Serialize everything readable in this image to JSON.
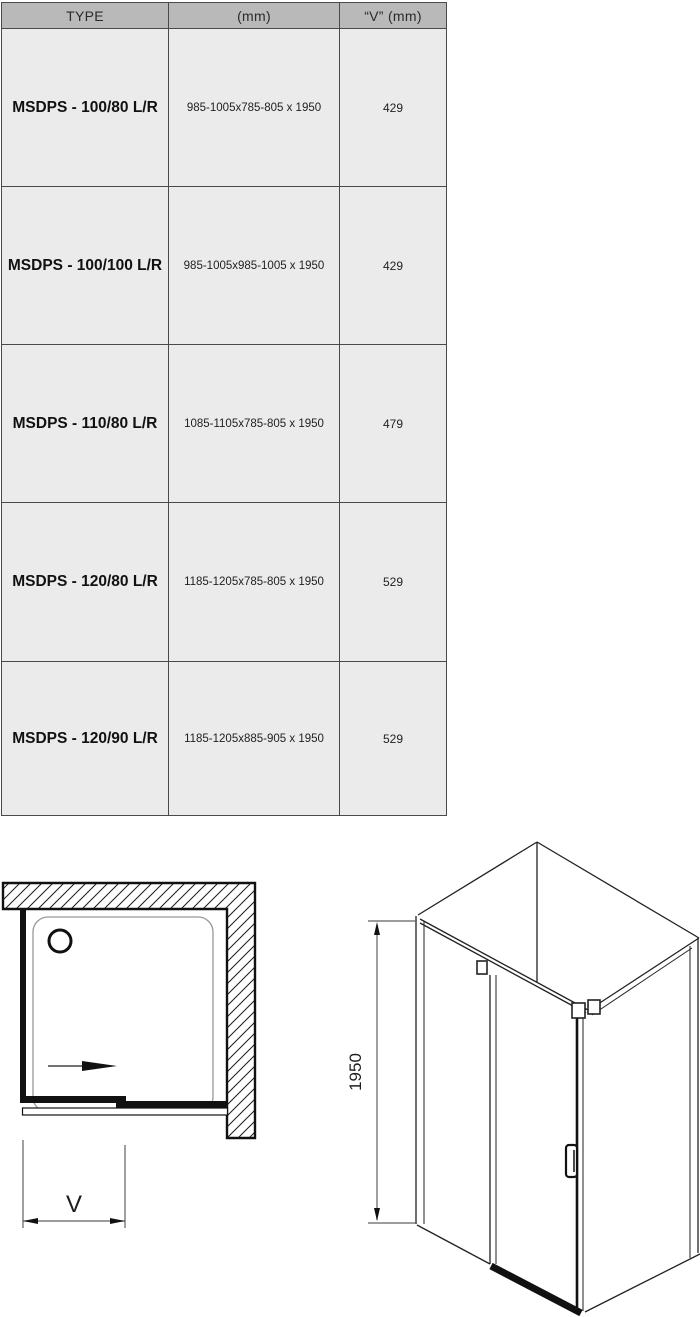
{
  "table": {
    "headers": [
      "TYPE",
      "(mm)",
      "“V”  (mm)"
    ],
    "rows": [
      {
        "type": "MSDPS - 100/80 L/R",
        "dimensions": "985-1005x785-805 x 1950",
        "v": "429"
      },
      {
        "type": "MSDPS - 100/100 L/R",
        "dimensions": "985-1005x985-1005 x 1950",
        "v": "429"
      },
      {
        "type": "MSDPS - 110/80 L/R",
        "dimensions": "1085-1105x785-805 x 1950",
        "v": "479"
      },
      {
        "type": "MSDPS - 120/80 L/R",
        "dimensions": "1185-1205x785-805 x 1950",
        "v": "529"
      },
      {
        "type": "MSDPS - 120/90 L/R",
        "dimensions": "1185-1205x885-905 x 1950",
        "v": "529"
      }
    ]
  },
  "diagrams": {
    "top_view": {
      "width_dimension_label": "V"
    },
    "iso_view": {
      "height_dimension_label": "1950"
    }
  },
  "colors": {
    "header_bg": "#b9b9b9",
    "row_bg": "#ebebeb",
    "grid_line": "#4a4a4a",
    "ink": "#111111",
    "dimension_line": "#606060"
  }
}
